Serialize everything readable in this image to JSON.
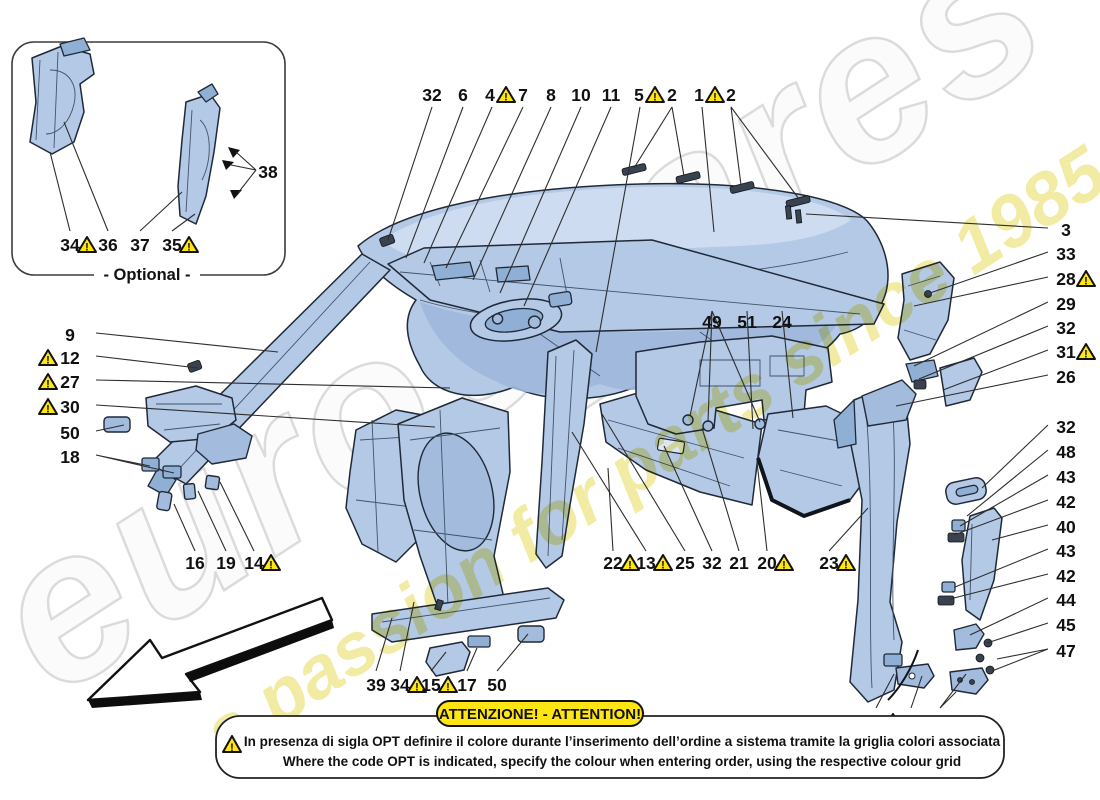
{
  "title": "Headliner trim and accessories - exploded parts diagram",
  "optional_box": {
    "label": "- Optional -"
  },
  "watermark": {
    "brand": "eurospares",
    "tagline": "a passion for parts since 1985",
    "brand_color": "#d8d8d8",
    "tagline_color": "#efe78d"
  },
  "attention": {
    "banner": "ATTENZIONE! - ATTENTION!",
    "line1": "In presenza di sigla OPT definire il colore durante l’inserimento dell’ordine a sistema tramite la griglia colori associata",
    "line2": "Where the code OPT is indicated, specify the colour when entering order, using the respective colour grid"
  },
  "colors": {
    "part_fill": "#b4c9e6",
    "part_shade": "#9db7da",
    "part_light": "#cddcf0",
    "outline": "#1f2937",
    "warning_yellow": "#ffe612",
    "leader_line": "#2e2e2e",
    "background": "#ffffff"
  },
  "callouts": [
    {
      "text": "32",
      "x": 432,
      "y": 95
    },
    {
      "text": "6",
      "x": 463,
      "y": 95
    },
    {
      "text": "4",
      "x": 490,
      "y": 95,
      "tx": 506
    },
    {
      "text": "7",
      "x": 523,
      "y": 95
    },
    {
      "text": "8",
      "x": 551,
      "y": 95
    },
    {
      "text": "10",
      "x": 581,
      "y": 95
    },
    {
      "text": "11",
      "x": 611,
      "y": 95
    },
    {
      "text": "5",
      "x": 639,
      "y": 95,
      "tx": 655
    },
    {
      "text": "2",
      "x": 672,
      "y": 95
    },
    {
      "text": "1",
      "x": 699,
      "y": 95,
      "tx": 715
    },
    {
      "text": "2",
      "x": 731,
      "y": 95
    },
    {
      "text": "3",
      "x": 1066,
      "y": 230
    },
    {
      "text": "33",
      "x": 1066,
      "y": 254
    },
    {
      "text": "28",
      "x": 1066,
      "y": 279,
      "tx": 1086
    },
    {
      "text": "29",
      "x": 1066,
      "y": 304
    },
    {
      "text": "32",
      "x": 1066,
      "y": 328
    },
    {
      "text": "31",
      "x": 1066,
      "y": 352,
      "tx": 1086
    },
    {
      "text": "26",
      "x": 1066,
      "y": 377
    },
    {
      "text": "32",
      "x": 1066,
      "y": 427
    },
    {
      "text": "48",
      "x": 1066,
      "y": 452
    },
    {
      "text": "43",
      "x": 1066,
      "y": 477
    },
    {
      "text": "42",
      "x": 1066,
      "y": 502
    },
    {
      "text": "40",
      "x": 1066,
      "y": 527
    },
    {
      "text": "43",
      "x": 1066,
      "y": 551
    },
    {
      "text": "42",
      "x": 1066,
      "y": 576
    },
    {
      "text": "44",
      "x": 1066,
      "y": 600
    },
    {
      "text": "45",
      "x": 1066,
      "y": 625
    },
    {
      "text": "47",
      "x": 1066,
      "y": 651
    },
    {
      "text": "9",
      "x": 70,
      "y": 335
    },
    {
      "text": "12",
      "x": 70,
      "y": 358,
      "tx": 48
    },
    {
      "text": "27",
      "x": 70,
      "y": 382,
      "tx": 48
    },
    {
      "text": "30",
      "x": 70,
      "y": 407,
      "tx": 48
    },
    {
      "text": "50",
      "x": 70,
      "y": 433
    },
    {
      "text": "18",
      "x": 70,
      "y": 457
    },
    {
      "text": "16",
      "x": 195,
      "y": 563
    },
    {
      "text": "19",
      "x": 226,
      "y": 563
    },
    {
      "text": "14",
      "x": 254,
      "y": 563,
      "tx": 271
    },
    {
      "text": "49",
      "x": 712,
      "y": 322
    },
    {
      "text": "51",
      "x": 747,
      "y": 322
    },
    {
      "text": "24",
      "x": 782,
      "y": 322
    },
    {
      "text": "22",
      "x": 613,
      "y": 563,
      "tx": 630
    },
    {
      "text": "13",
      "x": 646,
      "y": 563,
      "tx": 663
    },
    {
      "text": "25",
      "x": 685,
      "y": 563
    },
    {
      "text": "32",
      "x": 712,
      "y": 563
    },
    {
      "text": "21",
      "x": 739,
      "y": 563
    },
    {
      "text": "20",
      "x": 767,
      "y": 563,
      "tx": 784
    },
    {
      "text": "23",
      "x": 829,
      "y": 563,
      "tx": 846
    },
    {
      "text": "39",
      "x": 376,
      "y": 685
    },
    {
      "text": "34",
      "x": 400,
      "y": 685,
      "tx": 417
    },
    {
      "text": "15",
      "x": 431,
      "y": 685,
      "tx": 448
    },
    {
      "text": "17",
      "x": 467,
      "y": 685
    },
    {
      "text": "50",
      "x": 497,
      "y": 685
    },
    {
      "text": "35",
      "x": 876,
      "y": 722,
      "tx": 893
    },
    {
      "text": "41",
      "x": 911,
      "y": 722
    },
    {
      "text": "46",
      "x": 940,
      "y": 722
    },
    {
      "text": "34",
      "x": 70,
      "y": 245,
      "tx": 87
    },
    {
      "text": "36",
      "x": 108,
      "y": 245
    },
    {
      "text": "37",
      "x": 140,
      "y": 245
    },
    {
      "text": "35",
      "x": 172,
      "y": 245,
      "tx": 189
    },
    {
      "text": "38",
      "x": 268,
      "y": 172
    }
  ]
}
